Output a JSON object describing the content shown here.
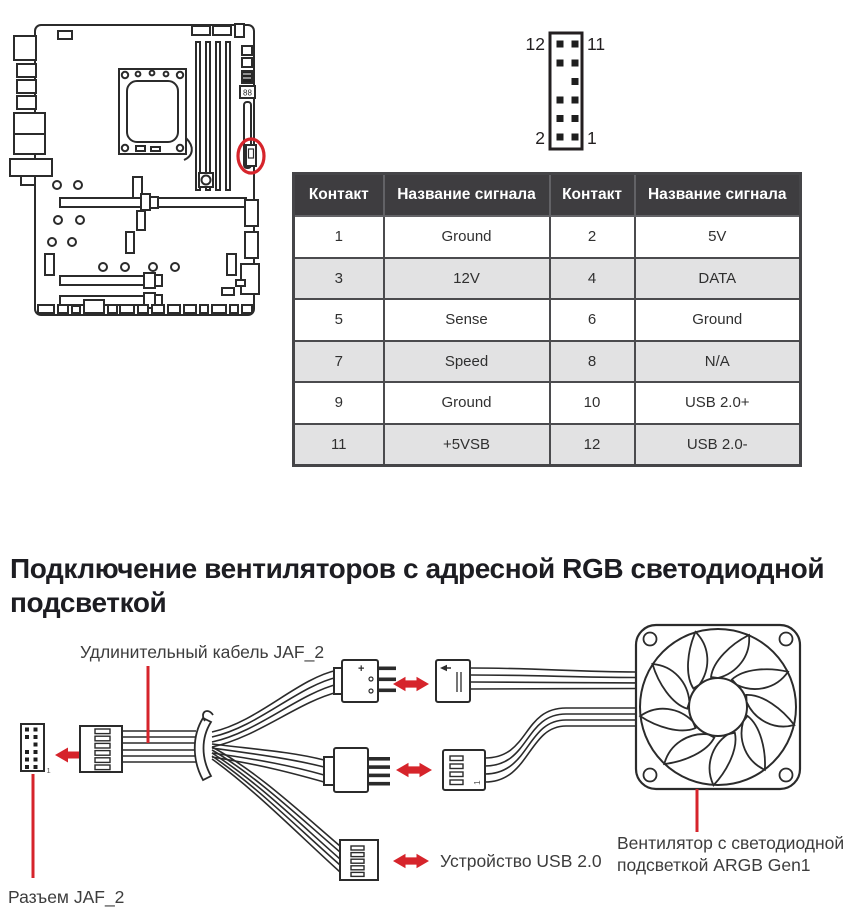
{
  "colors": {
    "accent_red": "#d6242b",
    "line": "#2b2b2b"
  },
  "motherboard": {
    "debug_led": "88"
  },
  "pin_header": {
    "label_top_left": "12",
    "label_top_right": "11",
    "label_bottom_left": "2",
    "label_bottom_right": "1"
  },
  "pin_table": {
    "headers": [
      "Контакт",
      "Название сигнала",
      "Контакт",
      "Название сигнала"
    ],
    "rows": [
      [
        "1",
        "Ground",
        "2",
        "5V"
      ],
      [
        "3",
        "12V",
        "4",
        "DATA"
      ],
      [
        "5",
        "Sense",
        "6",
        "Ground"
      ],
      [
        "7",
        "Speed",
        "8",
        "N/A"
      ],
      [
        "9",
        "Ground",
        "10",
        "USB 2.0+"
      ],
      [
        "11",
        "+5VSB",
        "12",
        "USB 2.0-"
      ]
    ]
  },
  "section": {
    "heading_line1": "Подключение вентиляторов с адресной RGB светодиодной",
    "heading_line2": "подсветкой"
  },
  "cable_diagram": {
    "extension_cable_label": "Удлинительный кабель JAF_2",
    "jaf2_connector_label": "Разъем JAF_2",
    "usb_device_label": "Устройство USB 2.0",
    "fan_label_line1": "Вентилятор с светодиодной",
    "fan_label_line2": "подсветкой ARGB Gen1",
    "plus_label": "+",
    "header_pin1": "1",
    "fan_connector_pin1": "1"
  }
}
